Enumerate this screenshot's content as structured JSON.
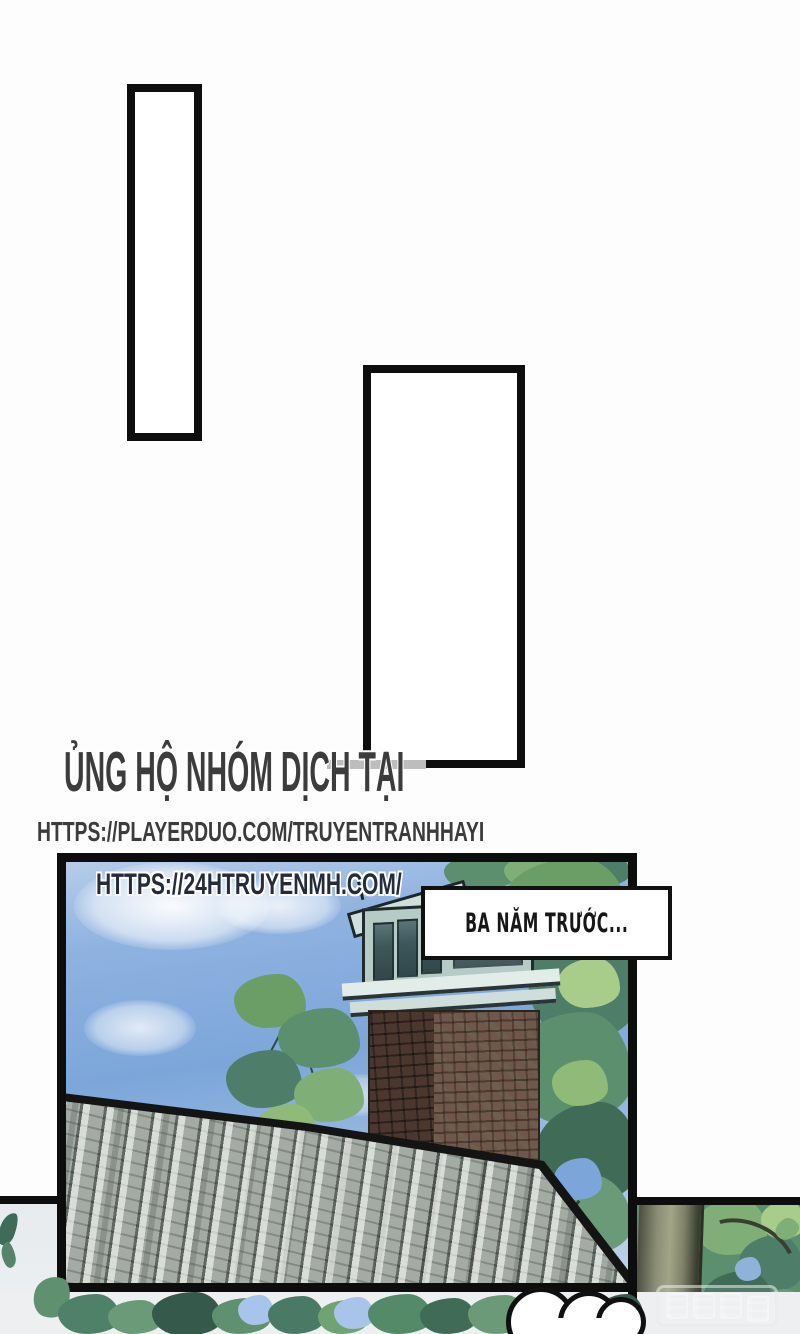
{
  "page": {
    "background": "#ffffff"
  },
  "support_header": {
    "title": "ỦNG HỘ NHÓM DỊCH TẠI",
    "url": "HTTPS://PLAYERDUO.COM/TRUYENTRANHHAYI",
    "text_color": "#3c3c3c"
  },
  "speech_bubbles": [
    {
      "id": "bubble-1",
      "text": ""
    },
    {
      "id": "bubble-2",
      "text": ""
    }
  ],
  "panel": {
    "site_watermark": "HTTPS://24HTRUYENMH.COM/",
    "site_watermark_color": "#242b3e",
    "caption": {
      "text": "BA NĂM TRƯỚC..."
    },
    "colors": {
      "sky": "#7ca6da",
      "sky_light": "#b6cde9",
      "foliage_dark": "#3f6b57",
      "foliage_mid": "#6b9e66",
      "foliage_light": "#8fba77",
      "brick_dark": "#4c372f",
      "brick_light": "#6f584b",
      "roof_gray": "#a9b0a9",
      "trunk": "#8b8e74",
      "panel_border": "#0d0d0d"
    }
  },
  "publisher_watermark": {
    "text": "腾讯动漫"
  }
}
